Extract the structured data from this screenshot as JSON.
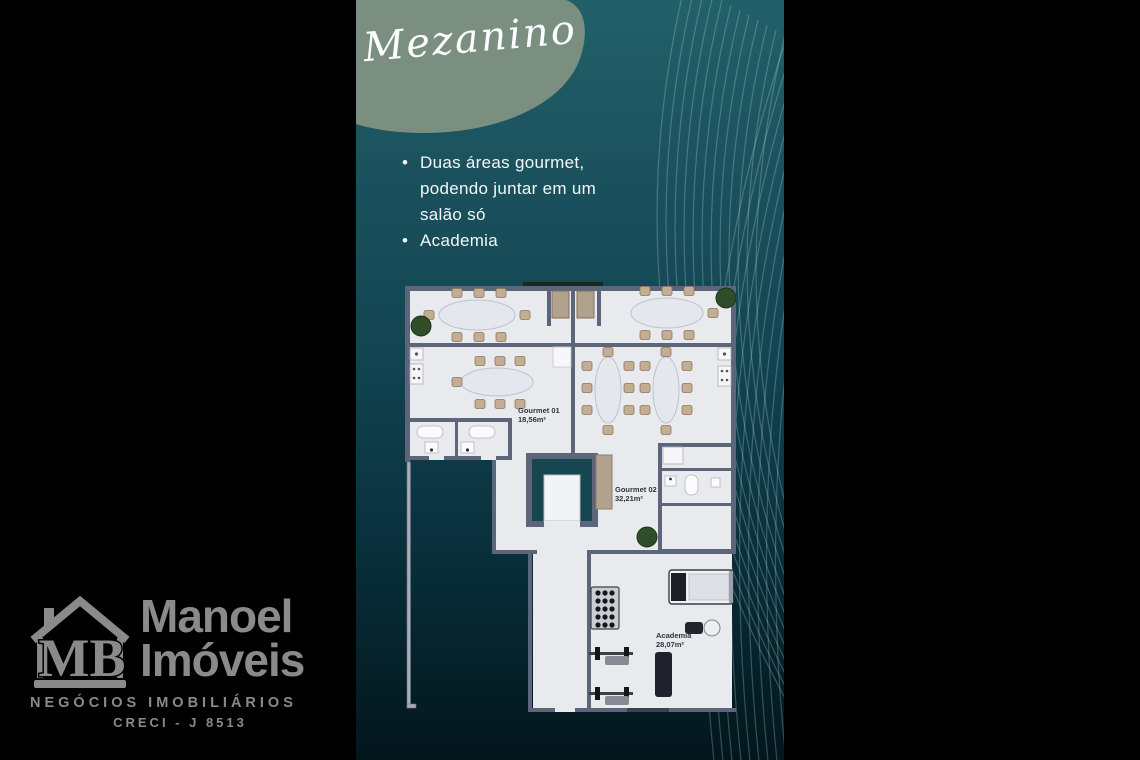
{
  "slide": {
    "title": "Mezanino",
    "bullets": [
      "Duas áreas gourmet, podendo juntar em um salão só",
      "Academia"
    ]
  },
  "floorplan": {
    "rooms": [
      {
        "name": "Gourmet 01",
        "area": "18,56m²"
      },
      {
        "name": "Gourmet 02",
        "area": "32,21m²"
      },
      {
        "name": "Academia",
        "area": "28,07m²"
      }
    ]
  },
  "logo": {
    "monogram": "MB",
    "name_line1": "Manoel",
    "name_line2": "Imóveis",
    "tagline": "NEGÓCIOS IMOBILIÁRIOS",
    "creci": "CRECI - J 8513"
  },
  "colors": {
    "background": "#000000",
    "panel_teal_top": "#226069",
    "panel_teal_bottom": "#03161c",
    "blob_sage": "#7a8f80",
    "text_white": "#f2f8f8",
    "logo_gray": "#8a8a8a",
    "floor": "#e9eaee",
    "wall": "#5c6579",
    "wood": "#b2a28d",
    "plant_green": "#2f4d28",
    "shaft_teal": "#174650"
  }
}
